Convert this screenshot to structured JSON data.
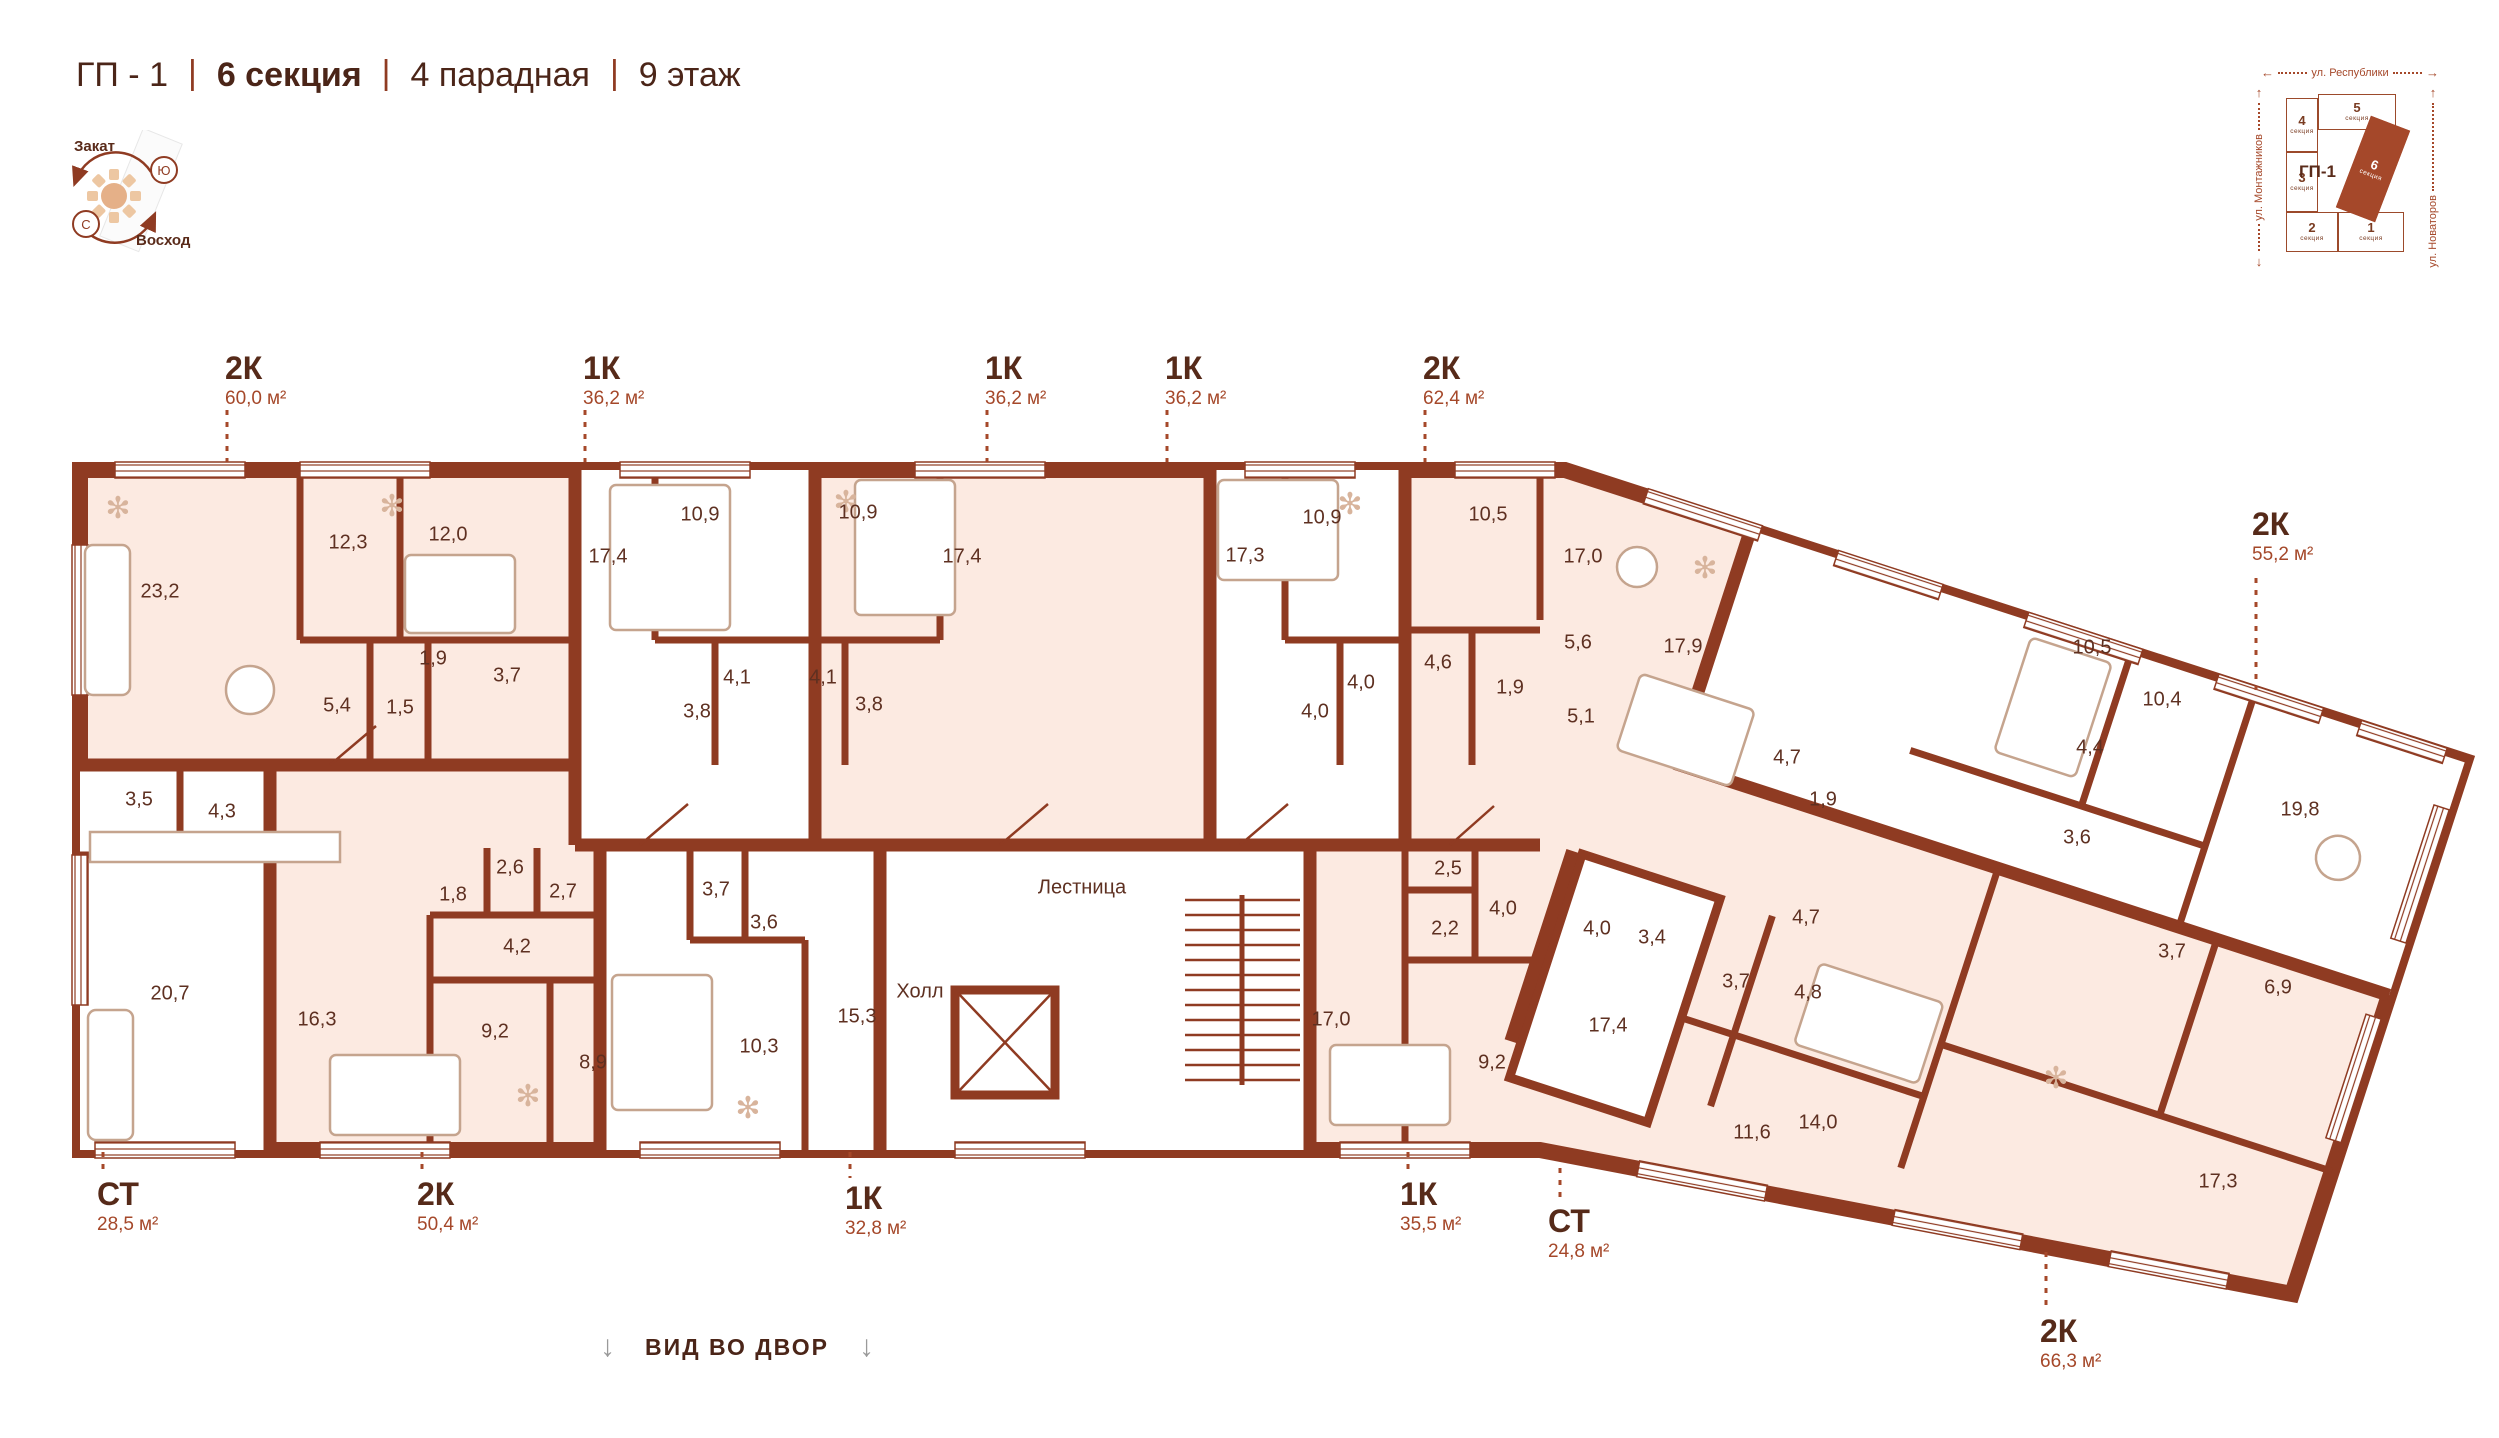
{
  "header": {
    "project": "ГП - 1",
    "section": "6 секция",
    "entrance": "4 парадная",
    "floor": "9 этаж",
    "sep": "|"
  },
  "units": {
    "m2": "м²"
  },
  "compass": {
    "sunset": "Закат",
    "sunrise": "Восход",
    "north": "С",
    "south": "Ю"
  },
  "minimap": {
    "title": "ГП-1",
    "section_word": "секция",
    "streets": {
      "top": "ул. Республики",
      "left": "ул. Монтажников",
      "right": "ул. Новаторов"
    },
    "sections": [
      {
        "num": "4"
      },
      {
        "num": "5"
      },
      {
        "num": "3"
      },
      {
        "num": "2"
      },
      {
        "num": "1"
      },
      {
        "num": "6"
      }
    ],
    "active_section": "6"
  },
  "plan": {
    "core": {
      "hall": "Холл",
      "stairs": "Лестница"
    },
    "callouts": [
      {
        "type": "2К",
        "area": "60,0"
      },
      {
        "type": "1К",
        "area": "36,2"
      },
      {
        "type": "1К",
        "area": "36,2"
      },
      {
        "type": "1К",
        "area": "36,2"
      },
      {
        "type": "2К",
        "area": "62,4"
      },
      {
        "type": "2К",
        "area": "55,2"
      },
      {
        "type": "СТ",
        "area": "28,5"
      },
      {
        "type": "2К",
        "area": "50,4"
      },
      {
        "type": "1К",
        "area": "32,8"
      },
      {
        "type": "1К",
        "area": "35,5"
      },
      {
        "type": "СТ",
        "area": "24,8"
      },
      {
        "type": "2К",
        "area": "66,3"
      }
    ],
    "rooms": [
      {
        "apt": "2К 60,0",
        "v": "23,2",
        "x": 160,
        "y": 592
      },
      {
        "apt": "2К 60,0",
        "v": "12,3",
        "x": 348,
        "y": 543
      },
      {
        "apt": "2К 60,0",
        "v": "12,0",
        "x": 448,
        "y": 535
      },
      {
        "apt": "2К 60,0",
        "v": "1,9",
        "x": 433,
        "y": 659
      },
      {
        "apt": "2К 60,0",
        "v": "3,7",
        "x": 507,
        "y": 676
      },
      {
        "apt": "2К 60,0",
        "v": "5,4",
        "x": 337,
        "y": 706
      },
      {
        "apt": "2К 60,0",
        "v": "1,5",
        "x": 400,
        "y": 708
      },
      {
        "apt": "СТ 28,5",
        "v": "3,5",
        "x": 139,
        "y": 800
      },
      {
        "apt": "СТ 28,5",
        "v": "4,3",
        "x": 222,
        "y": 812
      },
      {
        "apt": "СТ 28,5",
        "v": "20,7",
        "x": 170,
        "y": 994
      },
      {
        "apt": "1К 36,2 (2)",
        "v": "17,4",
        "x": 608,
        "y": 557
      },
      {
        "apt": "1К 36,2 (2)",
        "v": "10,9",
        "x": 700,
        "y": 515
      },
      {
        "apt": "1К 36,2 (2)",
        "v": "3,8",
        "x": 697,
        "y": 712
      },
      {
        "apt": "1К 36,2 (2)",
        "v": "4,1",
        "x": 737,
        "y": 678
      },
      {
        "apt": "1К 36,2 (3)",
        "v": "10,9",
        "x": 858,
        "y": 513
      },
      {
        "apt": "1К 36,2 (3)",
        "v": "17,4",
        "x": 962,
        "y": 557
      },
      {
        "apt": "1К 36,2 (3)",
        "v": "4,1",
        "x": 823,
        "y": 678
      },
      {
        "apt": "1К 36,2 (3)",
        "v": "3,8",
        "x": 869,
        "y": 705
      },
      {
        "apt": "1К 36,2 (4)",
        "v": "17,3",
        "x": 1245,
        "y": 556
      },
      {
        "apt": "1К 36,2 (4)",
        "v": "10,9",
        "x": 1322,
        "y": 518
      },
      {
        "apt": "1К 36,2 (4)",
        "v": "4,0",
        "x": 1361,
        "y": 683
      },
      {
        "apt": "1К 36,2 (4)",
        "v": "4,0",
        "x": 1315,
        "y": 712
      },
      {
        "apt": "2К 62,4",
        "v": "10,5",
        "x": 1488,
        "y": 515
      },
      {
        "apt": "2К 62,4",
        "v": "17,0",
        "x": 1583,
        "y": 557
      },
      {
        "apt": "2К 62,4",
        "v": "5,6",
        "x": 1578,
        "y": 643
      },
      {
        "apt": "2К 62,4",
        "v": "4,6",
        "x": 1438,
        "y": 663
      },
      {
        "apt": "2К 62,4",
        "v": "1,9",
        "x": 1510,
        "y": 688
      },
      {
        "apt": "2К 62,4",
        "v": "5,1",
        "x": 1581,
        "y": 717
      },
      {
        "apt": "2К 62,4",
        "v": "17,9",
        "x": 1683,
        "y": 647
      },
      {
        "apt": "2К 50,4",
        "v": "2,6",
        "x": 510,
        "y": 868
      },
      {
        "apt": "2К 50,4",
        "v": "2,7",
        "x": 563,
        "y": 892
      },
      {
        "apt": "2К 50,4",
        "v": "1,8",
        "x": 453,
        "y": 895
      },
      {
        "apt": "2К 50,4",
        "v": "4,2",
        "x": 517,
        "y": 947
      },
      {
        "apt": "2К 50,4",
        "v": "16,3",
        "x": 317,
        "y": 1020
      },
      {
        "apt": "2К 50,4",
        "v": "9,2",
        "x": 495,
        "y": 1032
      },
      {
        "apt": "2К 50,4",
        "v": "8,9",
        "x": 593,
        "y": 1063
      },
      {
        "apt": "1К 32,8",
        "v": "3,7",
        "x": 716,
        "y": 890
      },
      {
        "apt": "1К 32,8",
        "v": "3,6",
        "x": 764,
        "y": 923
      },
      {
        "apt": "1К 32,8",
        "v": "15,3",
        "x": 857,
        "y": 1017
      },
      {
        "apt": "1К 32,8",
        "v": "10,3",
        "x": 759,
        "y": 1047
      },
      {
        "apt": "1К 35,5",
        "v": "2,5",
        "x": 1448,
        "y": 869
      },
      {
        "apt": "1К 35,5",
        "v": "4,0",
        "x": 1503,
        "y": 909
      },
      {
        "apt": "1К 35,5",
        "v": "2,2",
        "x": 1445,
        "y": 929
      },
      {
        "apt": "1К 35,5",
        "v": "17,0",
        "x": 1331,
        "y": 1020
      },
      {
        "apt": "1К 35,5",
        "v": "9,2",
        "x": 1492,
        "y": 1063
      },
      {
        "apt": "СТ 24,8",
        "v": "4,0",
        "x": 1597,
        "y": 929
      },
      {
        "apt": "СТ 24,8",
        "v": "3,4",
        "x": 1652,
        "y": 938
      },
      {
        "apt": "СТ 24,8",
        "v": "17,4",
        "x": 1608,
        "y": 1026
      },
      {
        "apt": "2К 66,3",
        "v": "4,7",
        "x": 1806,
        "y": 918
      },
      {
        "apt": "2К 66,3",
        "v": "3,7",
        "x": 1736,
        "y": 982
      },
      {
        "apt": "2К 66,3",
        "v": "4,8",
        "x": 1808,
        "y": 993
      },
      {
        "apt": "2К 66,3",
        "v": "3,7",
        "x": 2172,
        "y": 952
      },
      {
        "apt": "2К 66,3",
        "v": "6,9",
        "x": 2278,
        "y": 988
      },
      {
        "apt": "2К 66,3",
        "v": "11,6",
        "x": 1752,
        "y": 1133
      },
      {
        "apt": "2К 66,3",
        "v": "14,0",
        "x": 1818,
        "y": 1123
      },
      {
        "apt": "2К 66,3",
        "v": "17,3",
        "x": 2218,
        "y": 1182
      },
      {
        "apt": "2К 55,2",
        "v": "4,7",
        "x": 1787,
        "y": 758
      },
      {
        "apt": "2К 55,2",
        "v": "1,9",
        "x": 1823,
        "y": 800
      },
      {
        "apt": "2К 55,2",
        "v": "10,5",
        "x": 2092,
        "y": 648
      },
      {
        "apt": "2К 55,2",
        "v": "10,4",
        "x": 2162,
        "y": 700
      },
      {
        "apt": "2К 55,2",
        "v": "4,4",
        "x": 2090,
        "y": 748
      },
      {
        "apt": "2К 55,2",
        "v": "3,6",
        "x": 2077,
        "y": 838
      },
      {
        "apt": "2К 55,2",
        "v": "19,8",
        "x": 2300,
        "y": 810
      }
    ]
  },
  "footer": {
    "view": "ВИД ВО ДВОР"
  },
  "colors": {
    "wall": "#8f3b22",
    "apartment_fill": "#fceae1",
    "accent": "#a5482a",
    "text_dark": "#4b2518",
    "room_text": "#5e3021"
  }
}
